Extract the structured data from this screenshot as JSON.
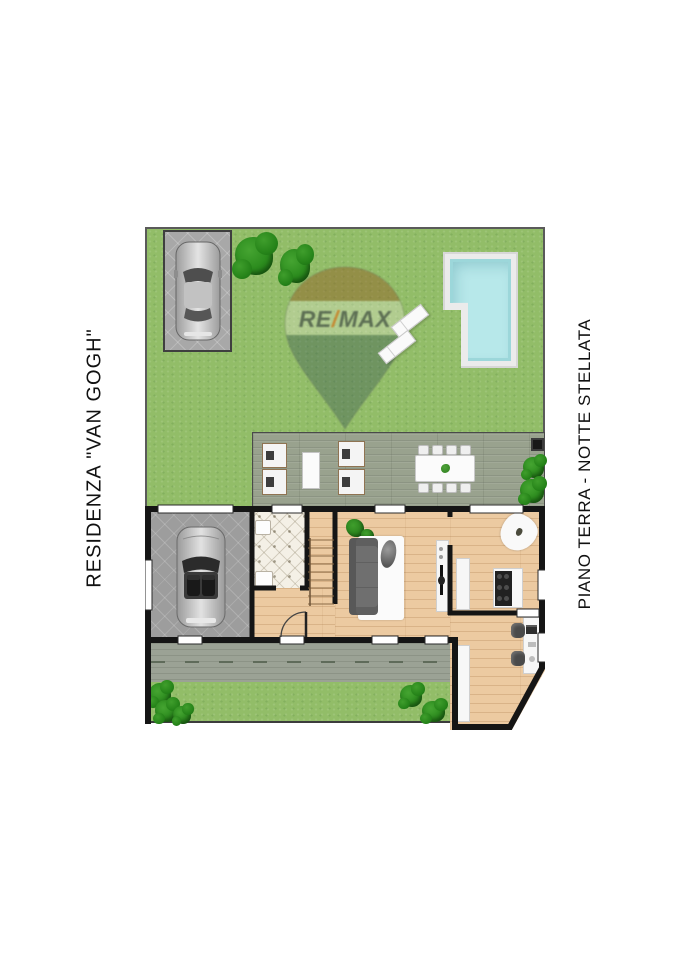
{
  "titles": {
    "left_vertical": "RESIDENZA \"VAN GOGH\"",
    "right_vertical": "PIANO TERRA - NOTTE STELLATA"
  },
  "watermark": {
    "re": "RE",
    "slash": "/",
    "max": "MAX",
    "full_text": "RE/MAX"
  },
  "colors": {
    "page_background": "#ffffff",
    "title_text": "#111111",
    "grass": "#92bd68",
    "bush": "#2c8c1e",
    "deck_wood": "#99a28e",
    "pool_water": "#b7e8ea",
    "pool_deck": "#ebebeb",
    "wall": "#151515",
    "interior_wood": "#eccaa1",
    "garage_floor": "#9d9d9d",
    "bathroom_tile": "#f4f0e6",
    "paving": "#9ba295",
    "furniture_white": "#f7f7f7",
    "sofa_gray": "#6f6f6f",
    "watermark_slash": "#cc8833",
    "car_silver": "#c0c0c0"
  },
  "elements": [
    "garden",
    "parking-space",
    "parked-car",
    "hedge",
    "swimming-pool",
    "pool-loungers",
    "remax-balloon-watermark",
    "wood-deck",
    "deck-loungers",
    "side-table",
    "outdoor-dining-table",
    "dining-chairs",
    "barbecue",
    "garage",
    "garage-car",
    "bathroom",
    "staircase",
    "hallway",
    "entrance-door",
    "living-room",
    "sofa",
    "rug",
    "pouf",
    "plants",
    "tv-cabinet",
    "tv",
    "kitchen",
    "kitchen-counter",
    "kitchen-island",
    "stove",
    "kitchen-rug",
    "study",
    "wardrobe",
    "desk",
    "office-chairs",
    "paved-path"
  ]
}
